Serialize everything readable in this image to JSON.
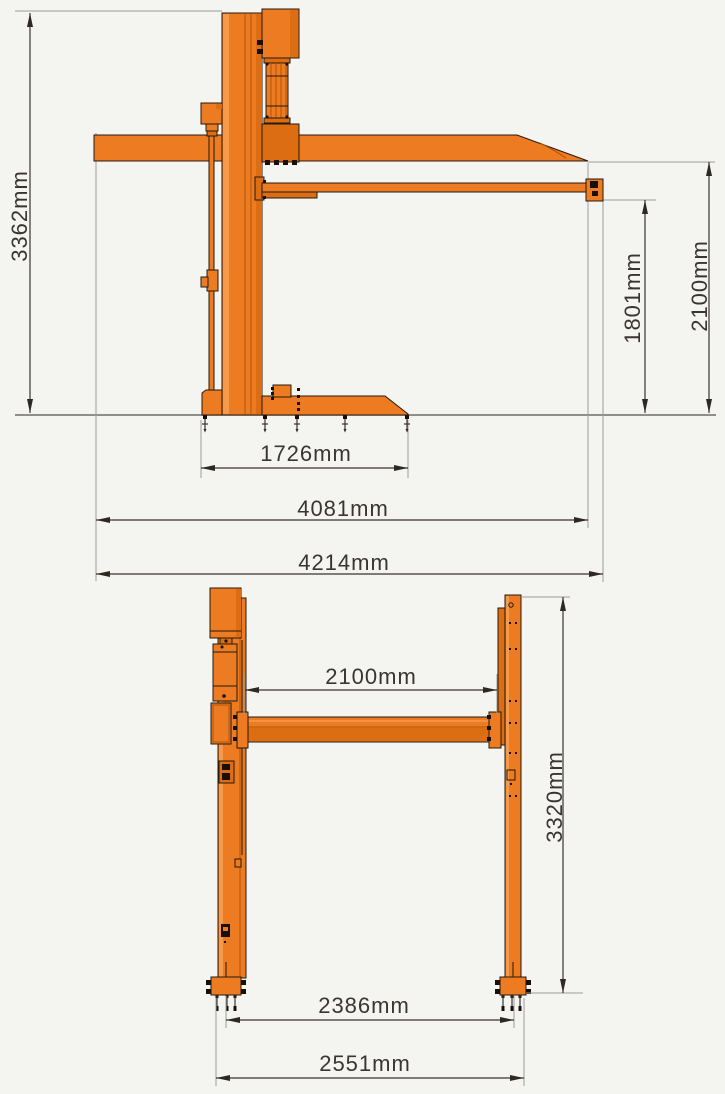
{
  "drawing": {
    "subject": "two-post parking lift technical drawing",
    "unit": "mm"
  },
  "side_view": {
    "dimensions": {
      "total_height": "3362mm",
      "arm_underside_height": "1801mm",
      "roof_underside_height": "2100mm",
      "base_length": "1726mm",
      "body_length": "4081mm",
      "overall_length": "4214mm"
    }
  },
  "front_view": {
    "dimensions": {
      "inner_width": "2100mm",
      "column_height": "3320mm",
      "anchor_span": "2386mm",
      "overall_width": "2551mm"
    }
  },
  "colors": {
    "background": "#F4F4F1",
    "machine_orange": "#ED7B22",
    "machine_orange_dark": "#DD6D12",
    "machine_orange_light": "#F59A4B",
    "outline": "#241A10",
    "dimension_line": "#3A332D",
    "reference_line": "#9B9B98",
    "text": "#3B3530"
  }
}
